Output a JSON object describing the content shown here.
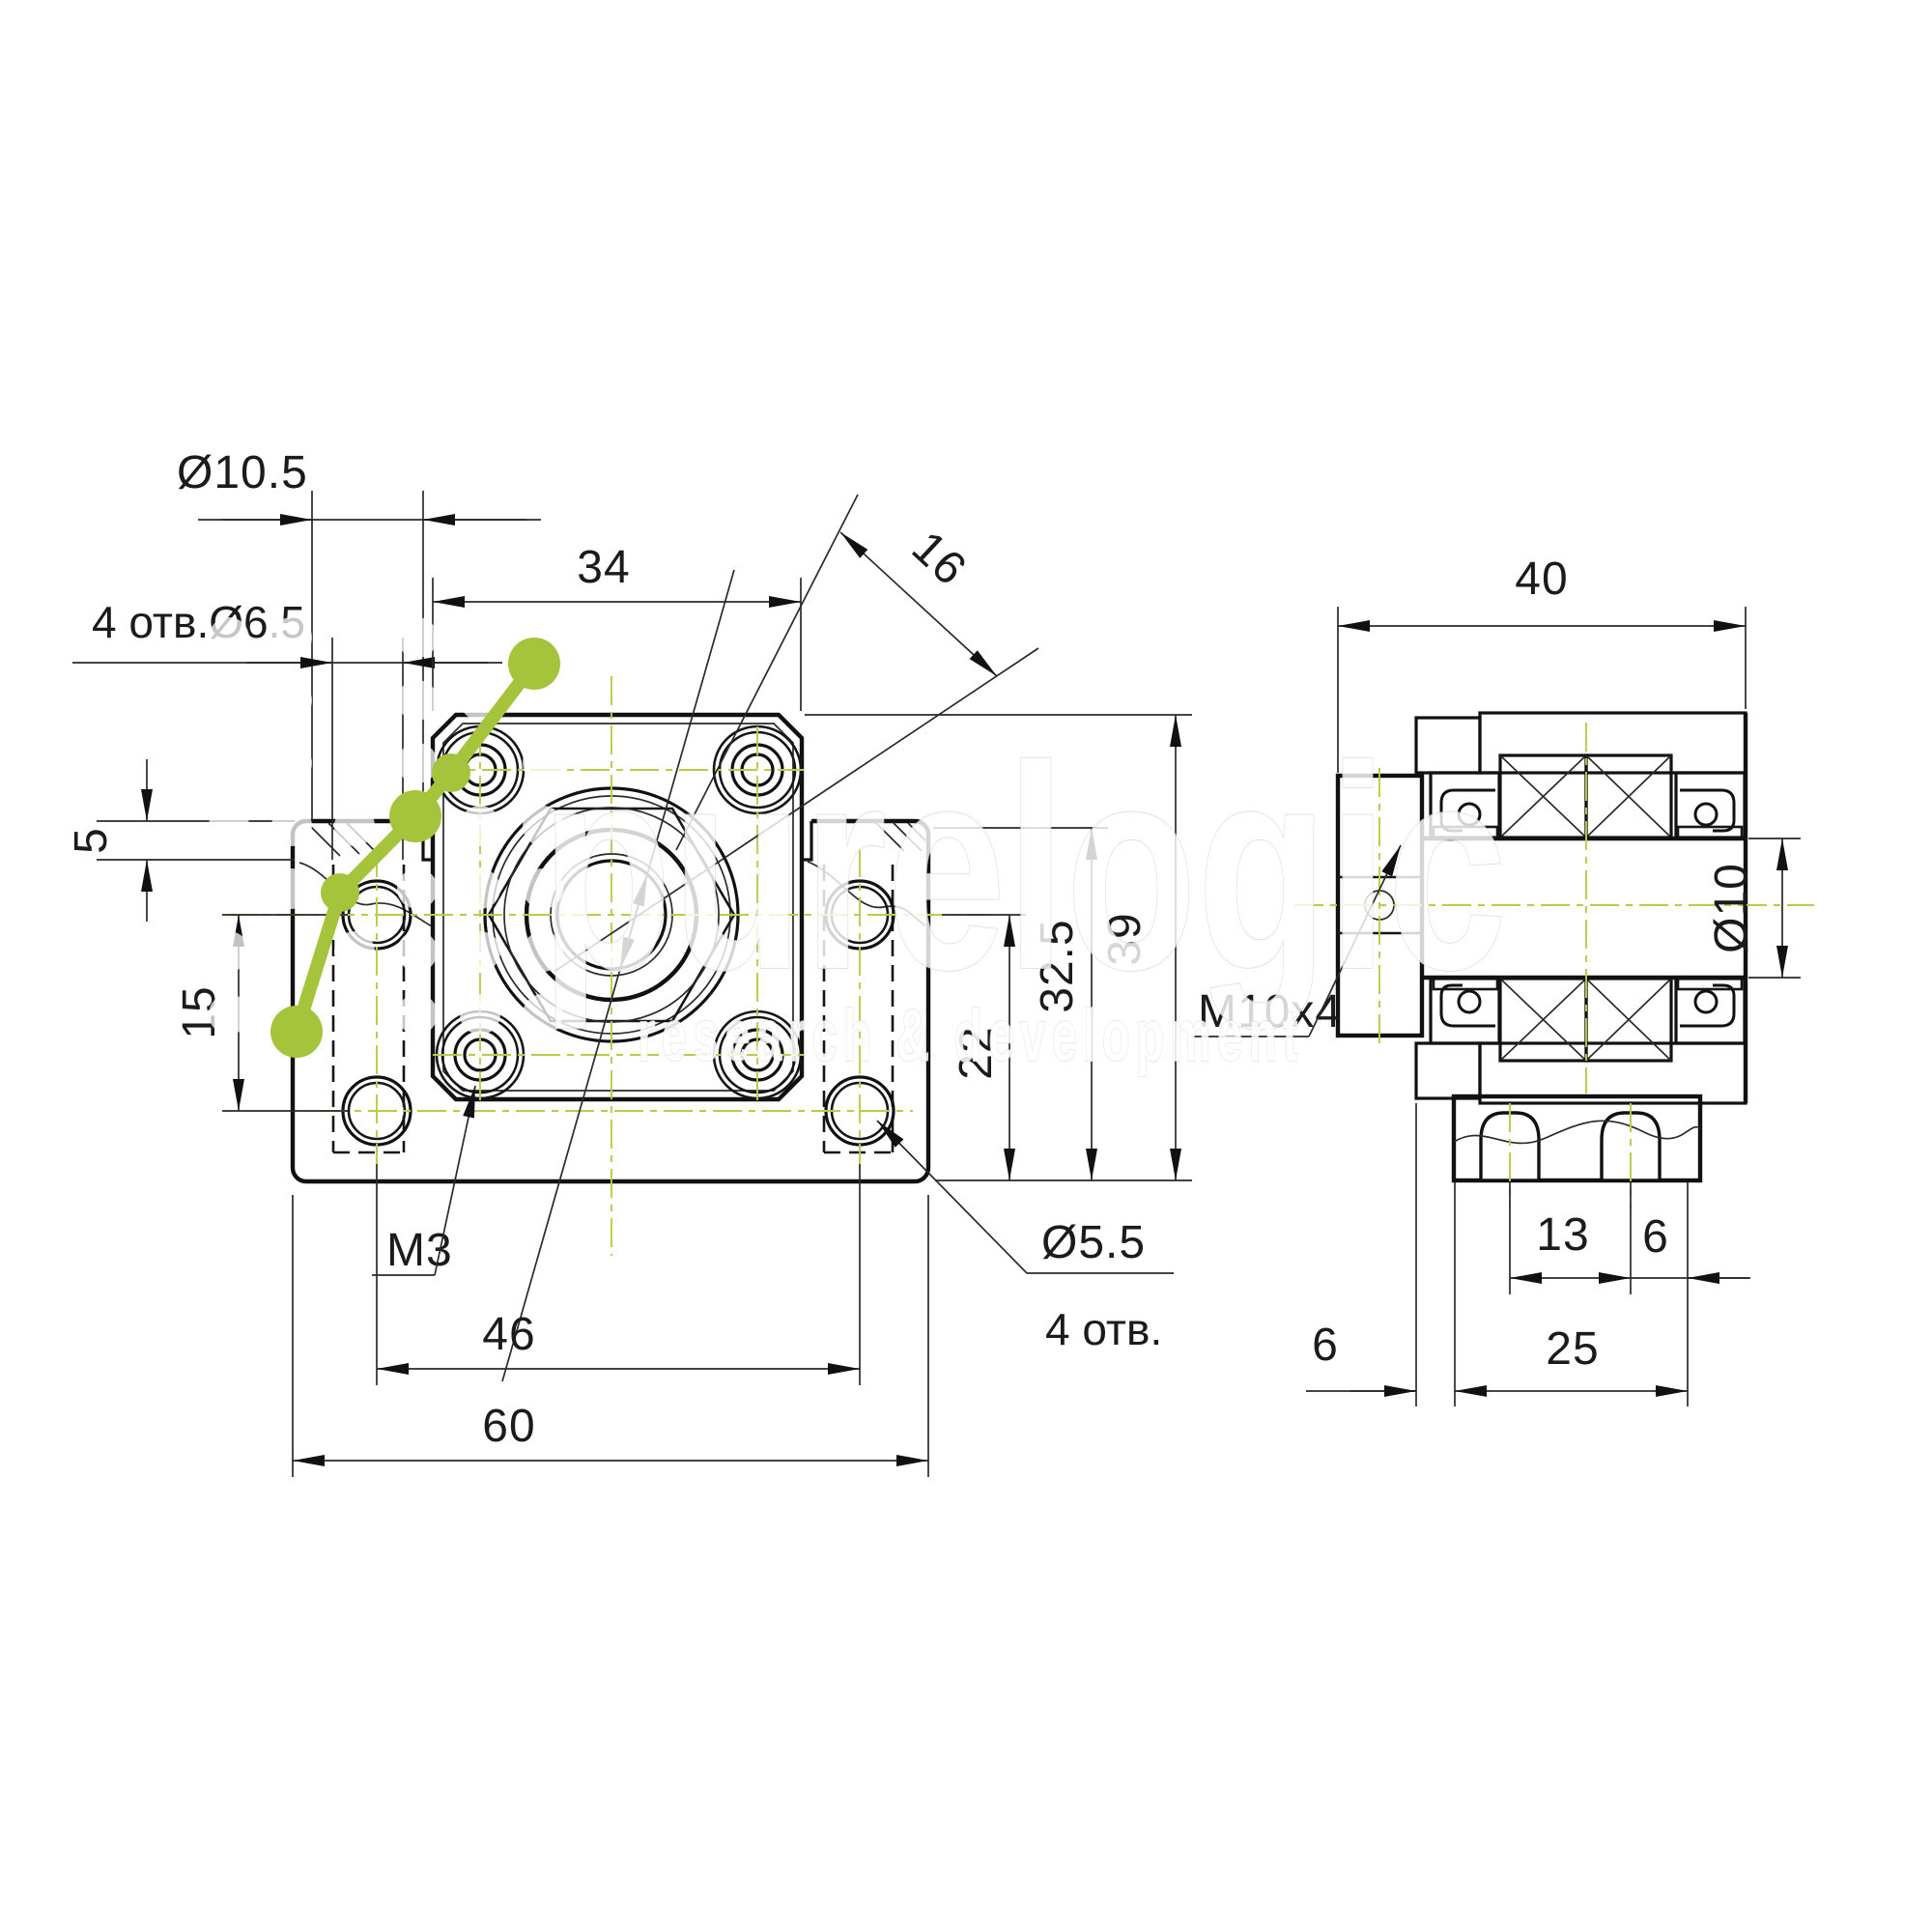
{
  "drawing": {
    "title": "bearing-support-block-two-view-drawing",
    "front_view": {
      "dims": {
        "counterbore_dia": "Ø10.5",
        "mount_holes": "4 отв.Ø6.5",
        "flange_width": "34",
        "bore_dia_diag": "16",
        "step_height": "5",
        "hole_row_spacing": "15",
        "center_height": "22",
        "base_height": "32.5",
        "total_height": "39",
        "screw_thread": "M3",
        "hole_spacing_h": "46",
        "base_width": "60",
        "rear_hole_dia": "Ø5.5",
        "rear_hole_qty": "4 отв."
      }
    },
    "side_view": {
      "dims": {
        "total_width": "40",
        "nut_thread": "M10x4",
        "shaft_dia": "Ø10",
        "foot_hole_spacing": "13",
        "foot_edge": "6",
        "foot_width": "25",
        "collar_offset": "6"
      }
    }
  },
  "watermark": {
    "brand": "purelogic",
    "tagline": "research & development",
    "logo_color": "#a6c33c"
  },
  "colors": {
    "line": "#111111",
    "centerline": "#b8cc48",
    "background": "#ffffff"
  }
}
